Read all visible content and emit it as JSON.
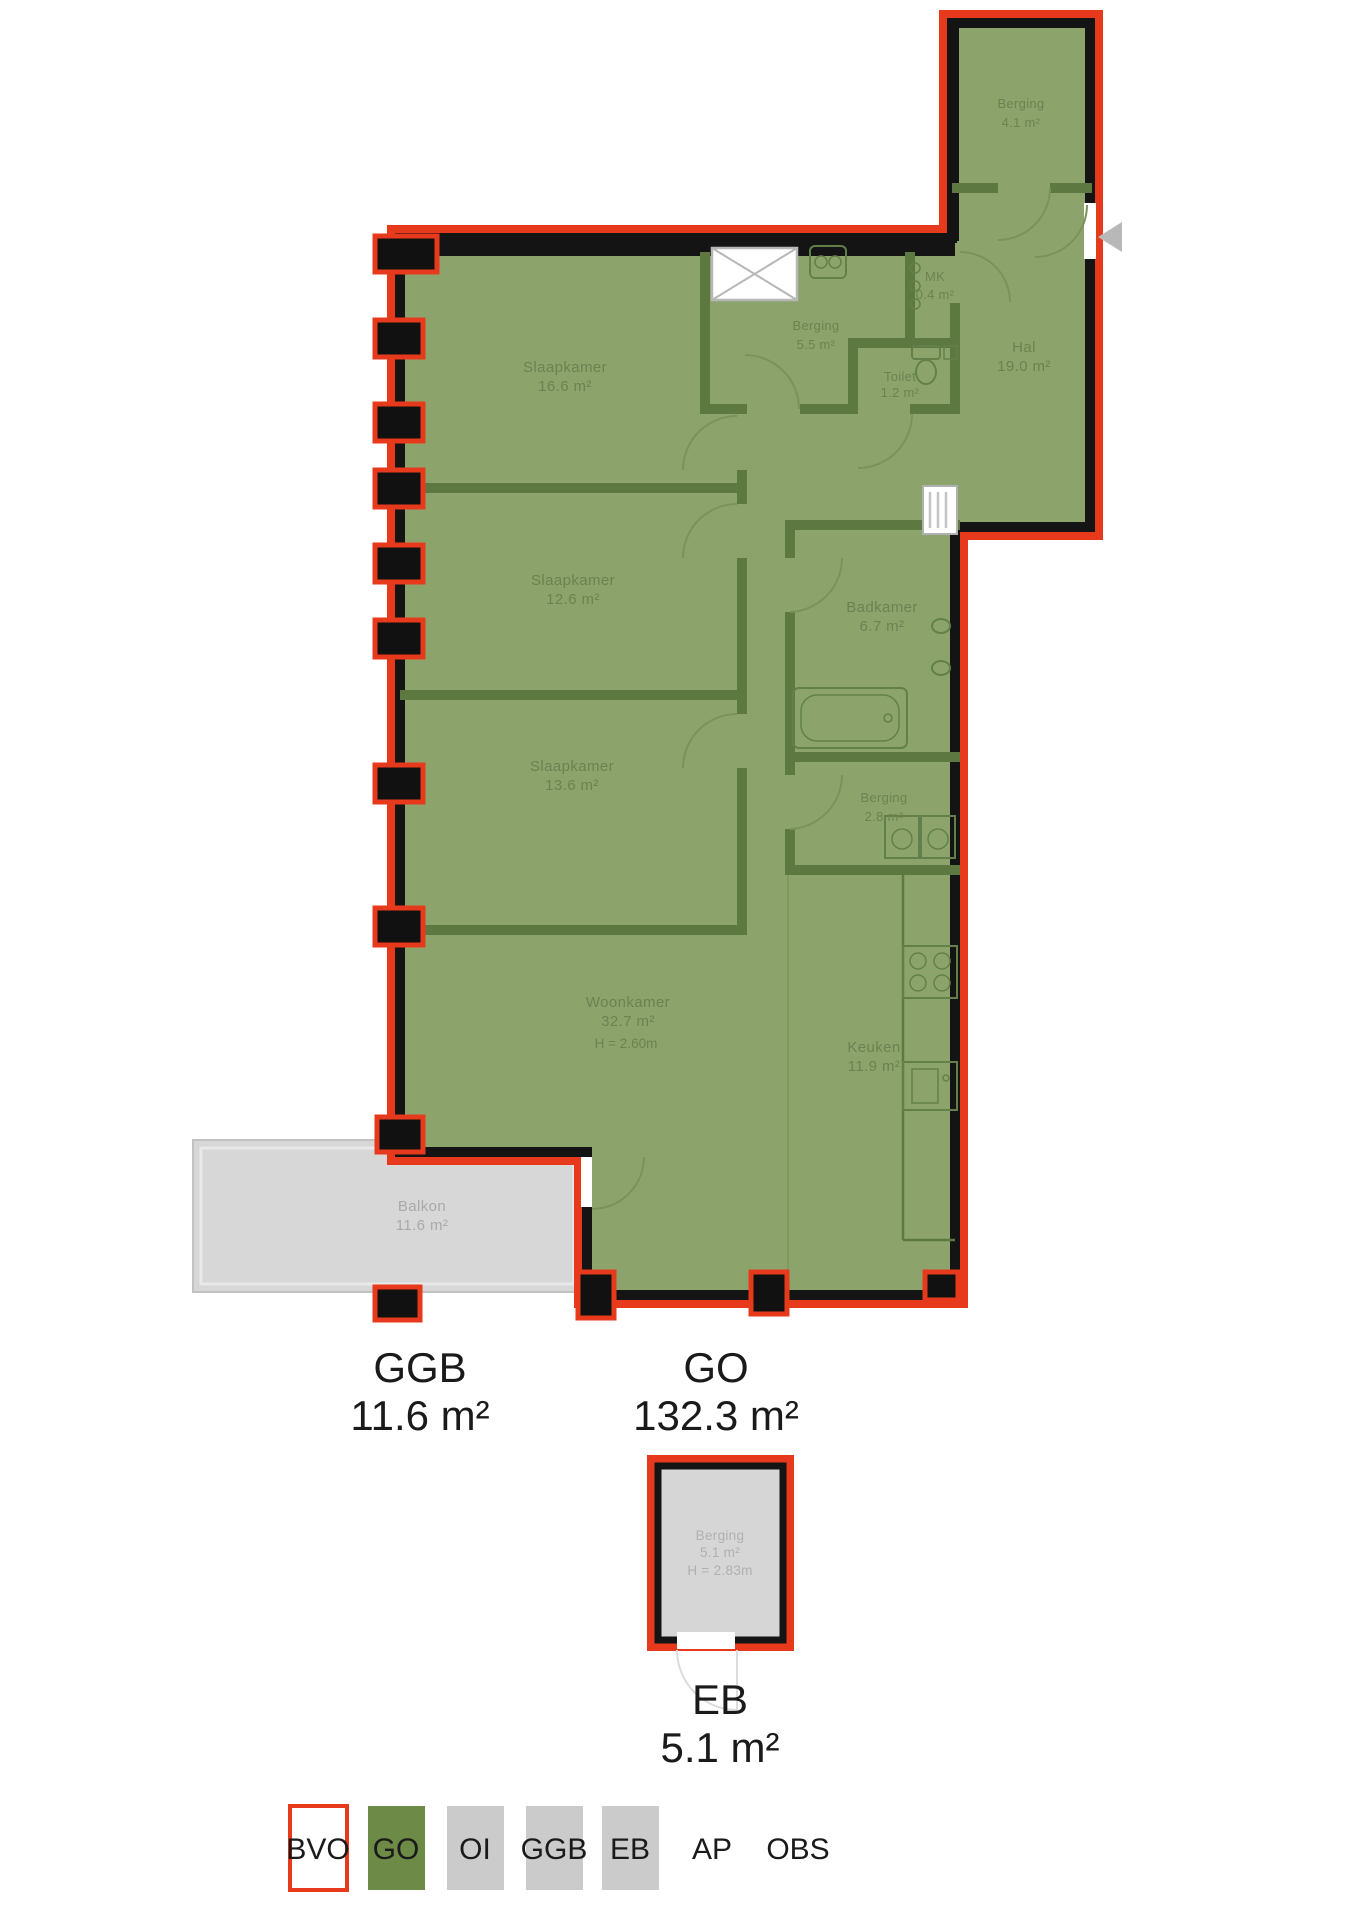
{
  "plan": {
    "rooms": {
      "berging_wing": {
        "name": "Berging",
        "area": "4.1 m²"
      },
      "hal": {
        "name": "Hal",
        "area": "19.0 m²"
      },
      "mk": {
        "name": "MK",
        "area": "0.4 m²"
      },
      "berging_5_5": {
        "name": "Berging",
        "area": "5.5 m²"
      },
      "toilet": {
        "name": "Toilet",
        "area": "1.2 m²"
      },
      "slaapkamer_1": {
        "name": "Slaapkamer",
        "area": "16.6 m²"
      },
      "slaapkamer_2": {
        "name": "Slaapkamer",
        "area": "12.6 m²"
      },
      "slaapkamer_3": {
        "name": "Slaapkamer",
        "area": "13.6 m²"
      },
      "badkamer": {
        "name": "Badkamer",
        "area": "6.7 m²"
      },
      "berging_2_8": {
        "name": "Berging",
        "area": "2.8 m²"
      },
      "woonkamer": {
        "name": "Woonkamer",
        "area": "32.7 m²",
        "height": "H = 2.60m"
      },
      "keuken": {
        "name": "Keuken",
        "area": "11.9 m²"
      },
      "balkon": {
        "name": "Balkon",
        "area": "11.6 m²"
      }
    }
  },
  "external": {
    "berging": {
      "name": "Berging",
      "area": "5.1 m²",
      "height": "H = 2.83m"
    }
  },
  "summary": {
    "ggb": {
      "label": "GGB",
      "value": "11.6 m²"
    },
    "go": {
      "label": "GO",
      "value": "132.3 m²"
    },
    "eb": {
      "label": "EB",
      "value": "5.1 m²"
    }
  },
  "legend": {
    "items": [
      {
        "label": "BVO",
        "swatch": "outline-red"
      },
      {
        "label": "GO",
        "swatch": "green"
      },
      {
        "label": "OI",
        "swatch": "gray"
      },
      {
        "label": "GGB",
        "swatch": "gray"
      },
      {
        "label": "EB",
        "swatch": "gray"
      },
      {
        "label": "AP",
        "swatch": "none"
      },
      {
        "label": "OBS",
        "swatch": "none"
      }
    ]
  },
  "colors": {
    "bvo_outline_red": "#e73a1c",
    "go_fill_green": "#8ca46b",
    "interior_wall_green": "#5d7840",
    "wall_black": "#141414",
    "legend_go_green": "#6d8a46",
    "legend_gray": "#cbcbcb",
    "balkon_gray": "#d7d7d7",
    "label_text_green": "#6e8152",
    "gray_label": "#a9a9a9"
  }
}
